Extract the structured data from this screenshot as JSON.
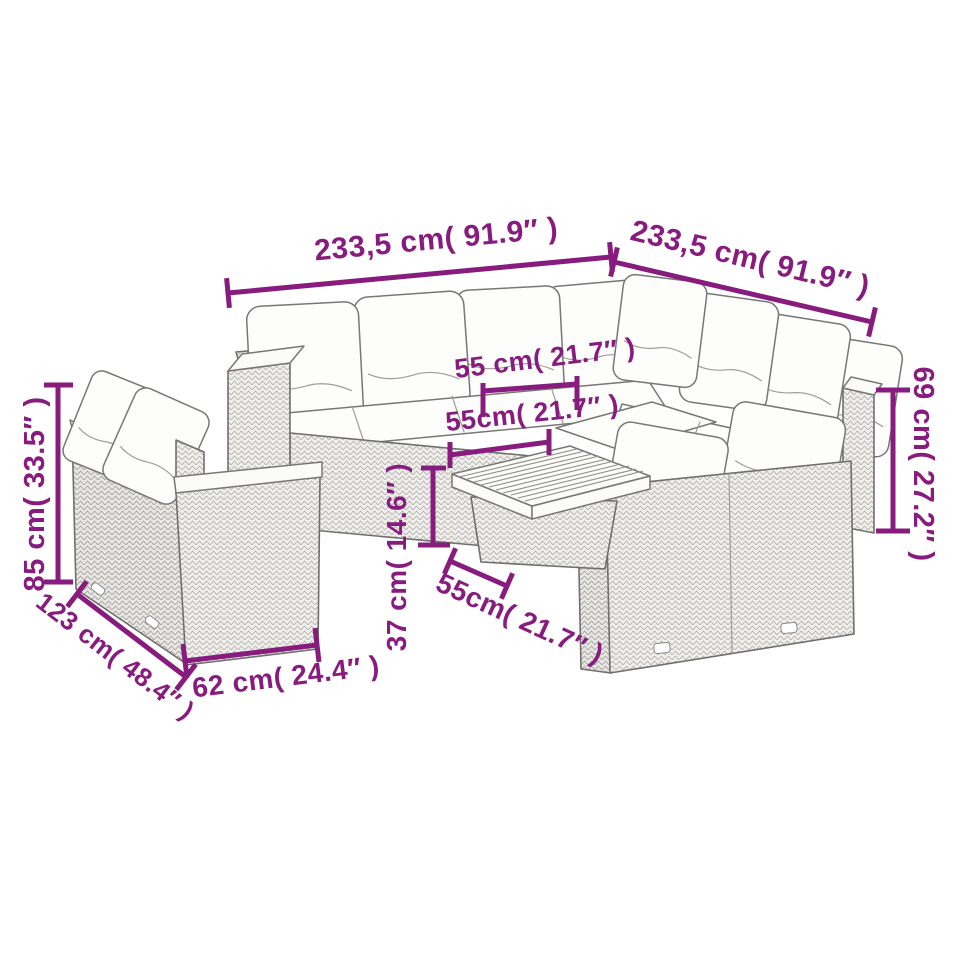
{
  "diagram": {
    "background": "#ffffff",
    "annotation_color": "#871c7e",
    "line_art_color": "#6f6f6d",
    "annotations": [
      {
        "id": "set-width-left",
        "label": "233,5 cm( 91.9″ )"
      },
      {
        "id": "set-width-right",
        "label": "233,5 cm( 91.9″ )"
      },
      {
        "id": "seat-width-upper",
        "label": "55 cm( 21.7″ )"
      },
      {
        "id": "seat-depth-middle",
        "label": "55cm( 21.7″ )"
      },
      {
        "id": "table-height-vertical",
        "label": "37 cm( 14.6″ )"
      },
      {
        "id": "table-width-lower",
        "label": "55cm( 21.7″ )"
      },
      {
        "id": "back-height-right",
        "label": "69 cm( 27.2″ )"
      },
      {
        "id": "back-height-left",
        "label": "85 cm( 33.5″ )"
      },
      {
        "id": "side-sofa-length",
        "label": "123 cm( 48.4″ )"
      },
      {
        "id": "side-sofa-depth",
        "label": "62 cm( 24.4″ )"
      }
    ]
  }
}
